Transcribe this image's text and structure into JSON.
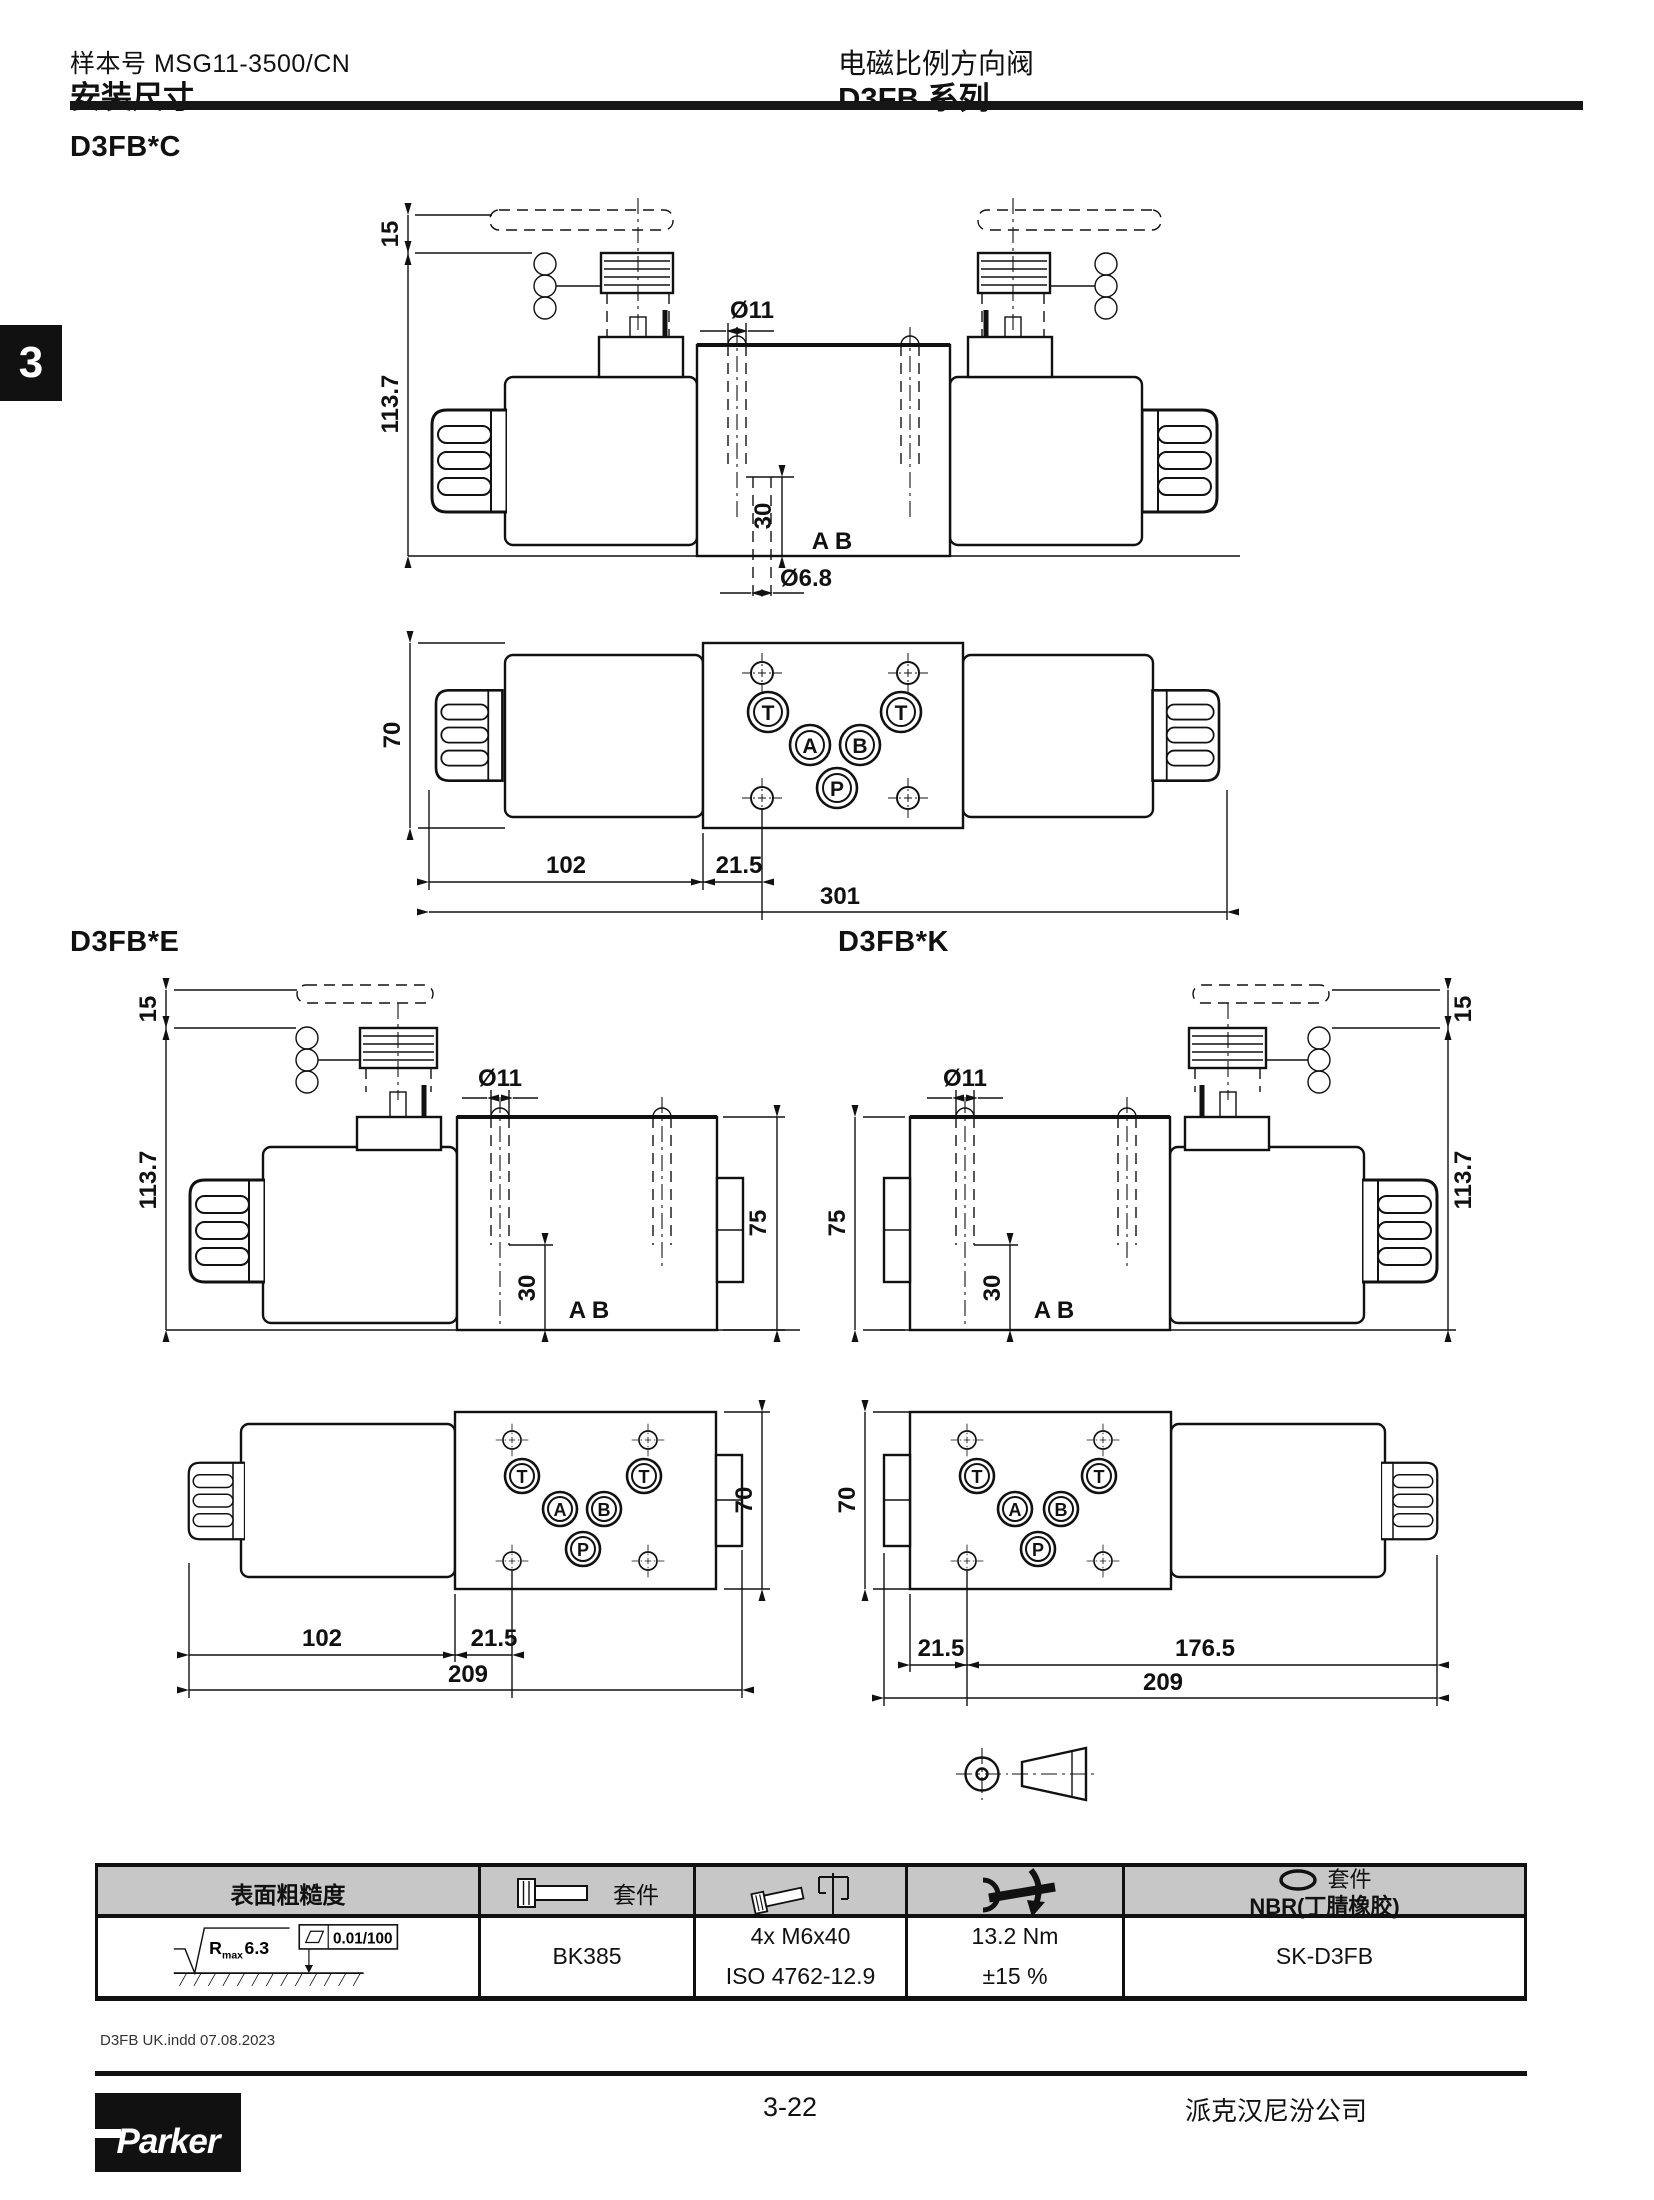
{
  "header": {
    "catalog_label": "样本号 MSG11-3500/CN",
    "doc_title": "安装尺寸",
    "product_title": "电磁比例方向阀",
    "series_title": "D3FB 系列"
  },
  "sidebar": {
    "chapter_tab": "3"
  },
  "drawings": {
    "c": {
      "label": "D3FB*C",
      "dim_15": "15",
      "dim_113": "113.7",
      "dim_dia11": "Ø11",
      "dim_30": "30",
      "ports_ab": "A B",
      "dim_dia68": "Ø6.8",
      "dim_70": "70",
      "dim_102": "102",
      "dim_21_5": "21.5",
      "dim_total": "301"
    },
    "e": {
      "label": "D3FB*E",
      "dim_15": "15",
      "dim_113": "113.7",
      "dim_dia11": "Ø11",
      "dim_75": "75",
      "dim_30": "30",
      "ports_ab": "A B",
      "dim_70": "70",
      "dim_102": "102",
      "dim_21_5": "21.5",
      "dim_total": "209"
    },
    "k": {
      "label": "D3FB*K",
      "dim_dia11": "Ø11",
      "dim_75": "75",
      "dim_30": "30",
      "ports_ab": "A B",
      "dim_15": "15",
      "dim_113": "113.7",
      "dim_70": "70",
      "dim_21_5": "21.5",
      "dim_176_5": "176.5",
      "dim_total": "209"
    }
  },
  "port_labels": {
    "t": "T",
    "a": "A",
    "b": "B",
    "p": "P"
  },
  "table": {
    "headers": {
      "surface": "表面粗糙度",
      "bolt_kit": "套件",
      "seal_kit": "套件",
      "seal_material": "NBR(丁腈橡胶)"
    },
    "row": {
      "roughness_r": "R",
      "roughness_sub": "max",
      "roughness_value": "6.3",
      "flatness": "0.01/100",
      "bolt_kit_code": "BK385",
      "bolts_qty": "4x M6x40",
      "bolts_standard": "ISO 4762-12.9",
      "torque": "13.2 Nm",
      "torque_tolerance": "±15 %",
      "seal_kit_code": "SK-D3FB"
    }
  },
  "footer": {
    "file_note": "D3FB UK.indd 07.08.2023",
    "page_number": "3-22",
    "company": "派克汉尼汾公司",
    "logo_text": "Parker"
  }
}
